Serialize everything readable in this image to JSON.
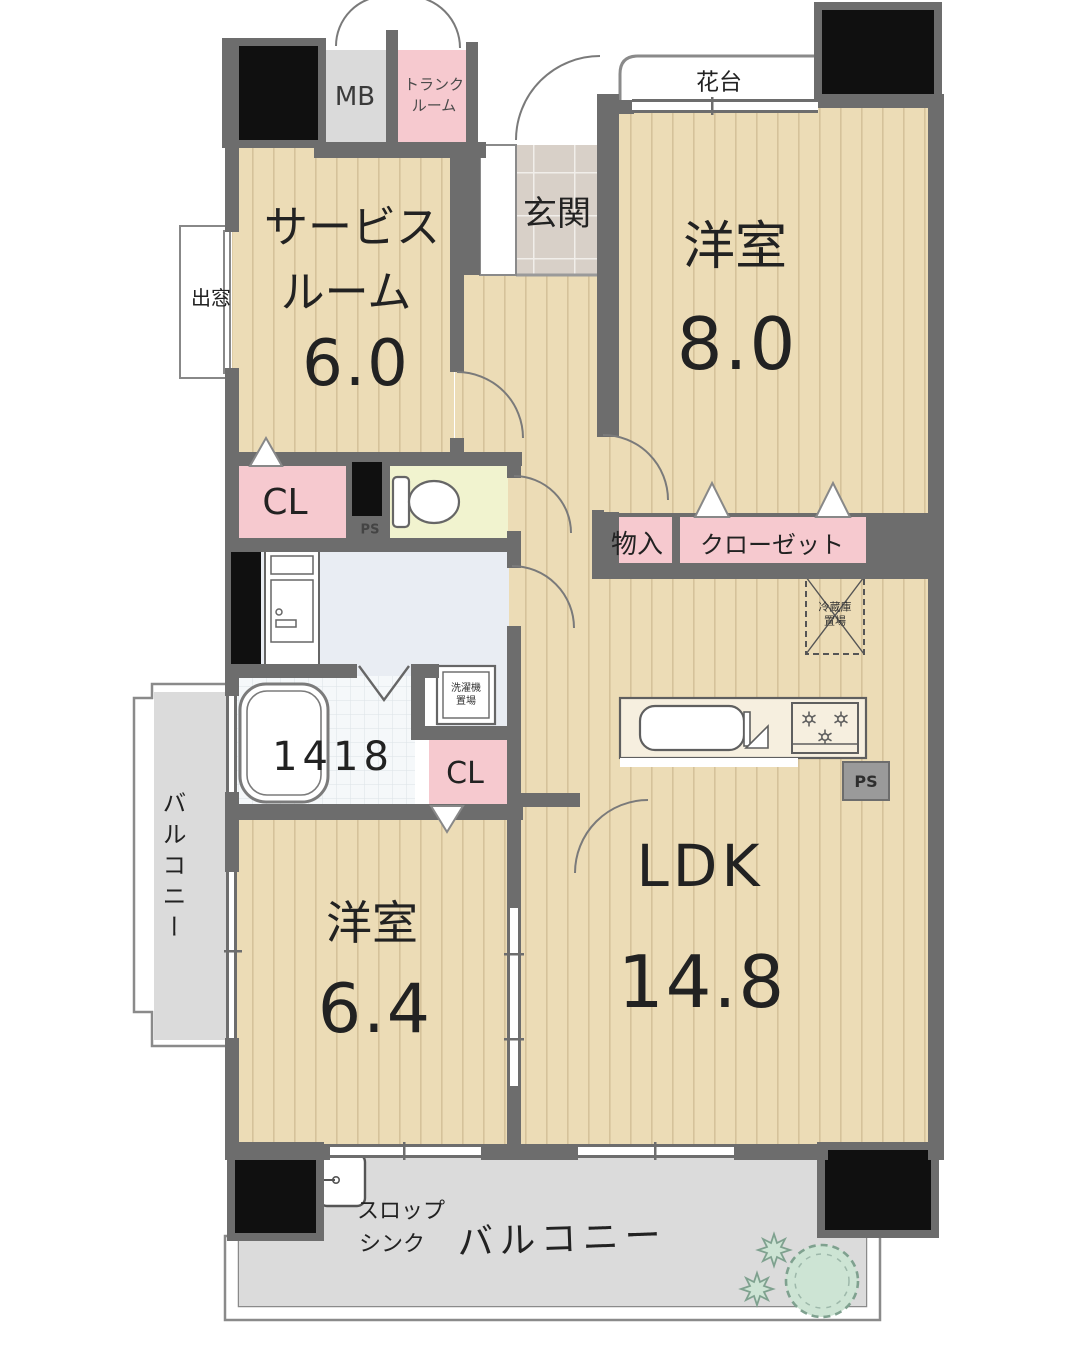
{
  "colors": {
    "wall": "#6d6d6d",
    "wood": "#ecdcb6",
    "pink": "#f6c9cf",
    "tile": "#d8d0c8",
    "wash": "#e9edf3",
    "toiletfloor": "#f1f3cf",
    "bath": "#f5f8fa",
    "balcony": "#dbdbdb",
    "blackblock": "#101010",
    "green": "#cde4d4"
  },
  "rooms": {
    "service": {
      "line1": "サービス",
      "line2": "ルーム",
      "size": "6.0"
    },
    "western8": {
      "name": "洋室",
      "size": "8.0"
    },
    "western64": {
      "name": "洋室",
      "size": "6.4"
    },
    "ldk": {
      "name": "LDK",
      "size": "14.8"
    },
    "entrance": {
      "name": "玄関"
    },
    "bath": {
      "size": "1418"
    }
  },
  "features": {
    "mb": "MB",
    "trunk": {
      "line1": "トランク",
      "line2": "ルーム"
    },
    "flower_stand": "花台",
    "bay_window": "出窓",
    "closet_upper": "CL",
    "closet_lower": "CL",
    "ps_upper": "PS",
    "ps_lower": "PS",
    "storage": "物入",
    "closet": "クローゼット",
    "fridge": {
      "line1": "冷蔵庫",
      "line2": "置場"
    },
    "washer": {
      "line1": "洗濯機",
      "line2": "置場"
    },
    "slop_sink": {
      "line1": "スロップ",
      "line2": "シンク"
    },
    "balcony_left": "バルコニー",
    "balcony_bottom": "バルコニー"
  }
}
